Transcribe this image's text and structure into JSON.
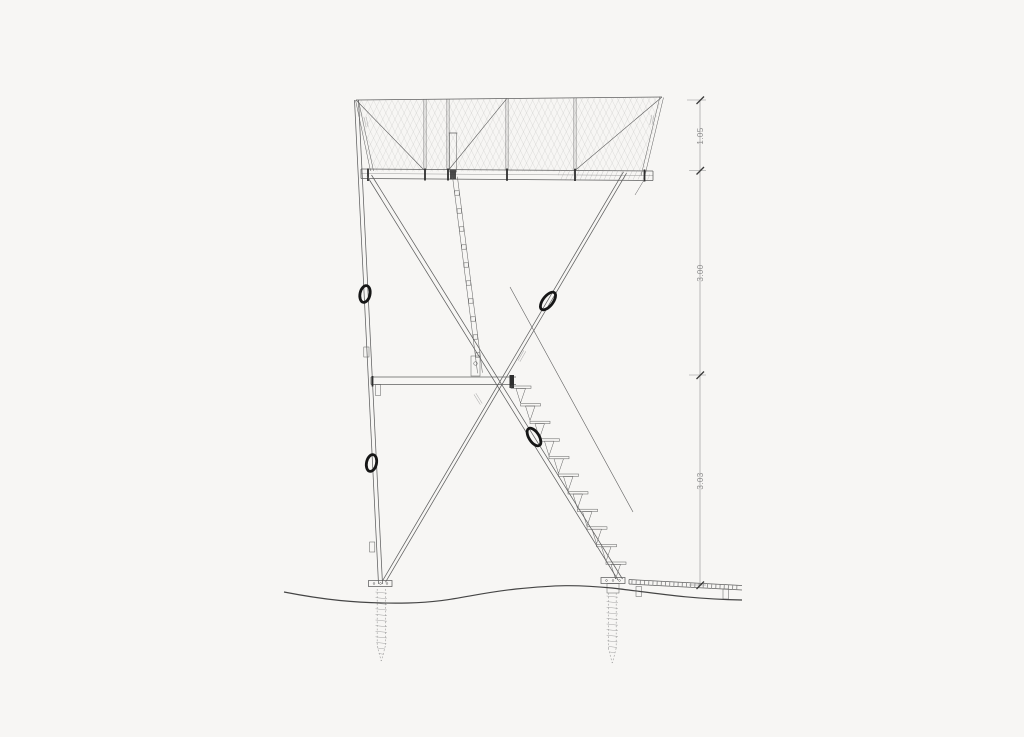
{
  "page": {
    "background": "#f7f6f4"
  },
  "colors": {
    "background": "#f7f6f4",
    "line": "#5f5f5f",
    "line-dark": "#2e2e2e",
    "line-light": "#9a9a9a",
    "mesh": "#c0bfbd",
    "ground": "#454545",
    "ring": "#161616",
    "dim": "#8f8f8f"
  },
  "drawing": {
    "dimensions": {
      "top": "1.05",
      "middle": "3.00",
      "bottom": "3.03"
    }
  }
}
